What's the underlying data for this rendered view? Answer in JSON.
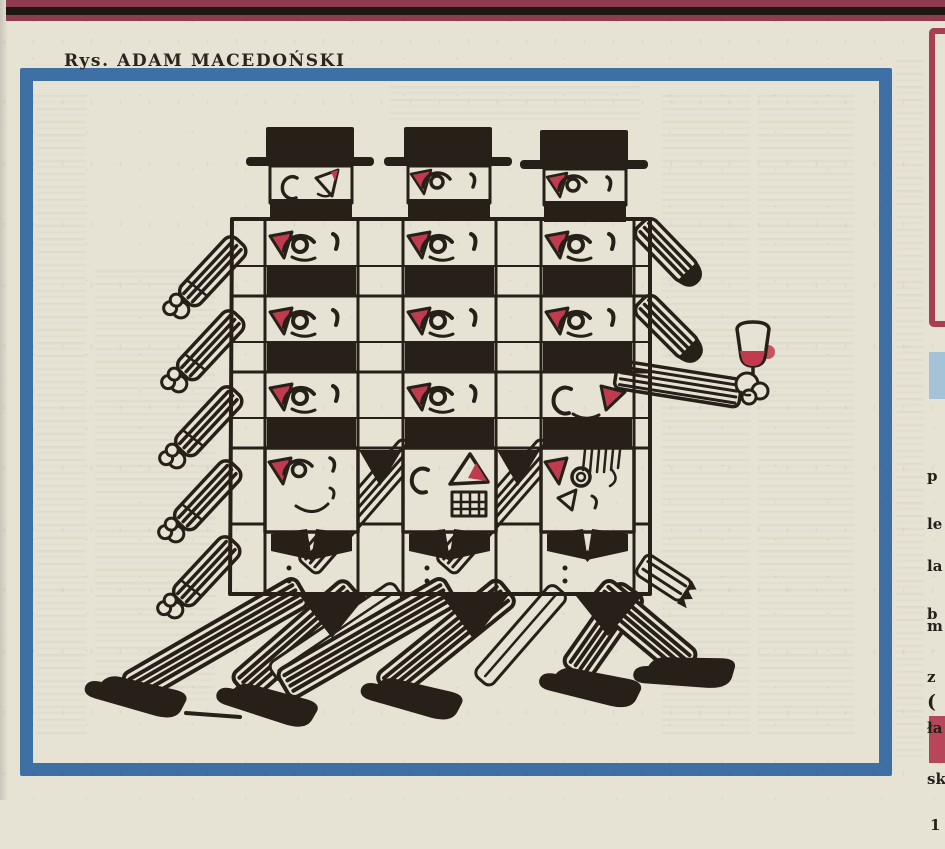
{
  "colors": {
    "paper": "#e6e3d5",
    "ink": "#262019",
    "red": "#c03b4d",
    "blue": "#3e6fa5",
    "bar_maroon": "#8e3b4d",
    "bar_black": "#1e1712",
    "lightblue_box": "#a5c3d8",
    "red_box": "#b8465b",
    "red_outline": "#a84054",
    "caption_ink": "#2a241e"
  },
  "caption": {
    "text": "Rys. ADAM MACEDOŃSKI"
  },
  "illustration": {
    "description": "Hand-drawn ink cartoon: three walking men in black hats merged into a lattice of identical hatted faces with red noses; striped arms and legs stick out of the grid, one fist holds a glass of red wine.",
    "grid_columns": 3,
    "face_rows": 4,
    "top_heads": 3
  },
  "right_column": {
    "text_fragments": [
      {
        "lines": [
          "p",
          "le"
        ]
      },
      {
        "lines": [
          "la",
          "b"
        ]
      },
      {
        "lines": [
          "m",
          "z",
          "ła",
          "sk"
        ]
      },
      {
        "lines": [
          "("
        ]
      },
      {
        "lines": [
          "1"
        ]
      }
    ]
  }
}
